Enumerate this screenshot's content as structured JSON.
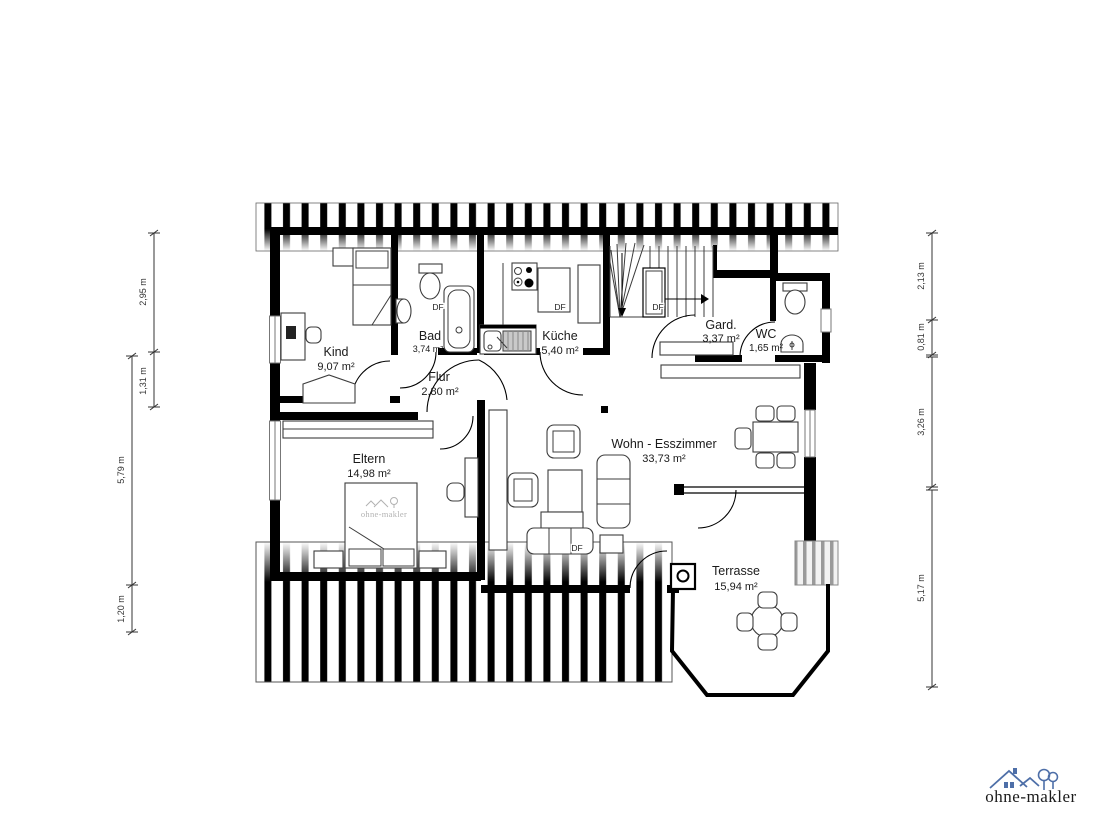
{
  "rooms": [
    {
      "id": "kind",
      "label": "Kind",
      "area": "9,07 m²"
    },
    {
      "id": "bad",
      "label": "Bad",
      "area": "3,74 m²"
    },
    {
      "id": "kueche",
      "label": "Küche",
      "area": "5,40 m²"
    },
    {
      "id": "flur",
      "label": "Flur",
      "area": "2,80 m²"
    },
    {
      "id": "eltern",
      "label": "Eltern",
      "area": "14,98 m²"
    },
    {
      "id": "wohn",
      "label": "Wohn - Esszimmer",
      "area": "33,73 m²"
    },
    {
      "id": "gard",
      "label": "Gard.",
      "area": "3,37 m²"
    },
    {
      "id": "wc",
      "label": "WC",
      "area": "1,65 m²"
    },
    {
      "id": "terrasse",
      "label": "Terrasse",
      "area": "15,94 m²"
    }
  ],
  "skylight_label": "DF",
  "dimensions": {
    "left_inner": [
      {
        "label": "2,95 m"
      },
      {
        "label": "1,31 m"
      }
    ],
    "left_outer": [
      {
        "label": "5,79 m"
      },
      {
        "label": "1,20 m"
      }
    ],
    "right": [
      {
        "label": "2,13 m"
      },
      {
        "label": "0,81 m"
      },
      {
        "label": "3,26 m"
      },
      {
        "label": "5,17 m"
      }
    ]
  },
  "watermark": {
    "text": "ohne-makler"
  },
  "logo": {
    "text": "ohne-makler",
    "color": "#4e6fa8"
  },
  "colors": {
    "wall": "#000000",
    "dimension": "#333333",
    "watermark_gray": "#b2b2b2",
    "logo_blue": "#4e6fa8"
  }
}
